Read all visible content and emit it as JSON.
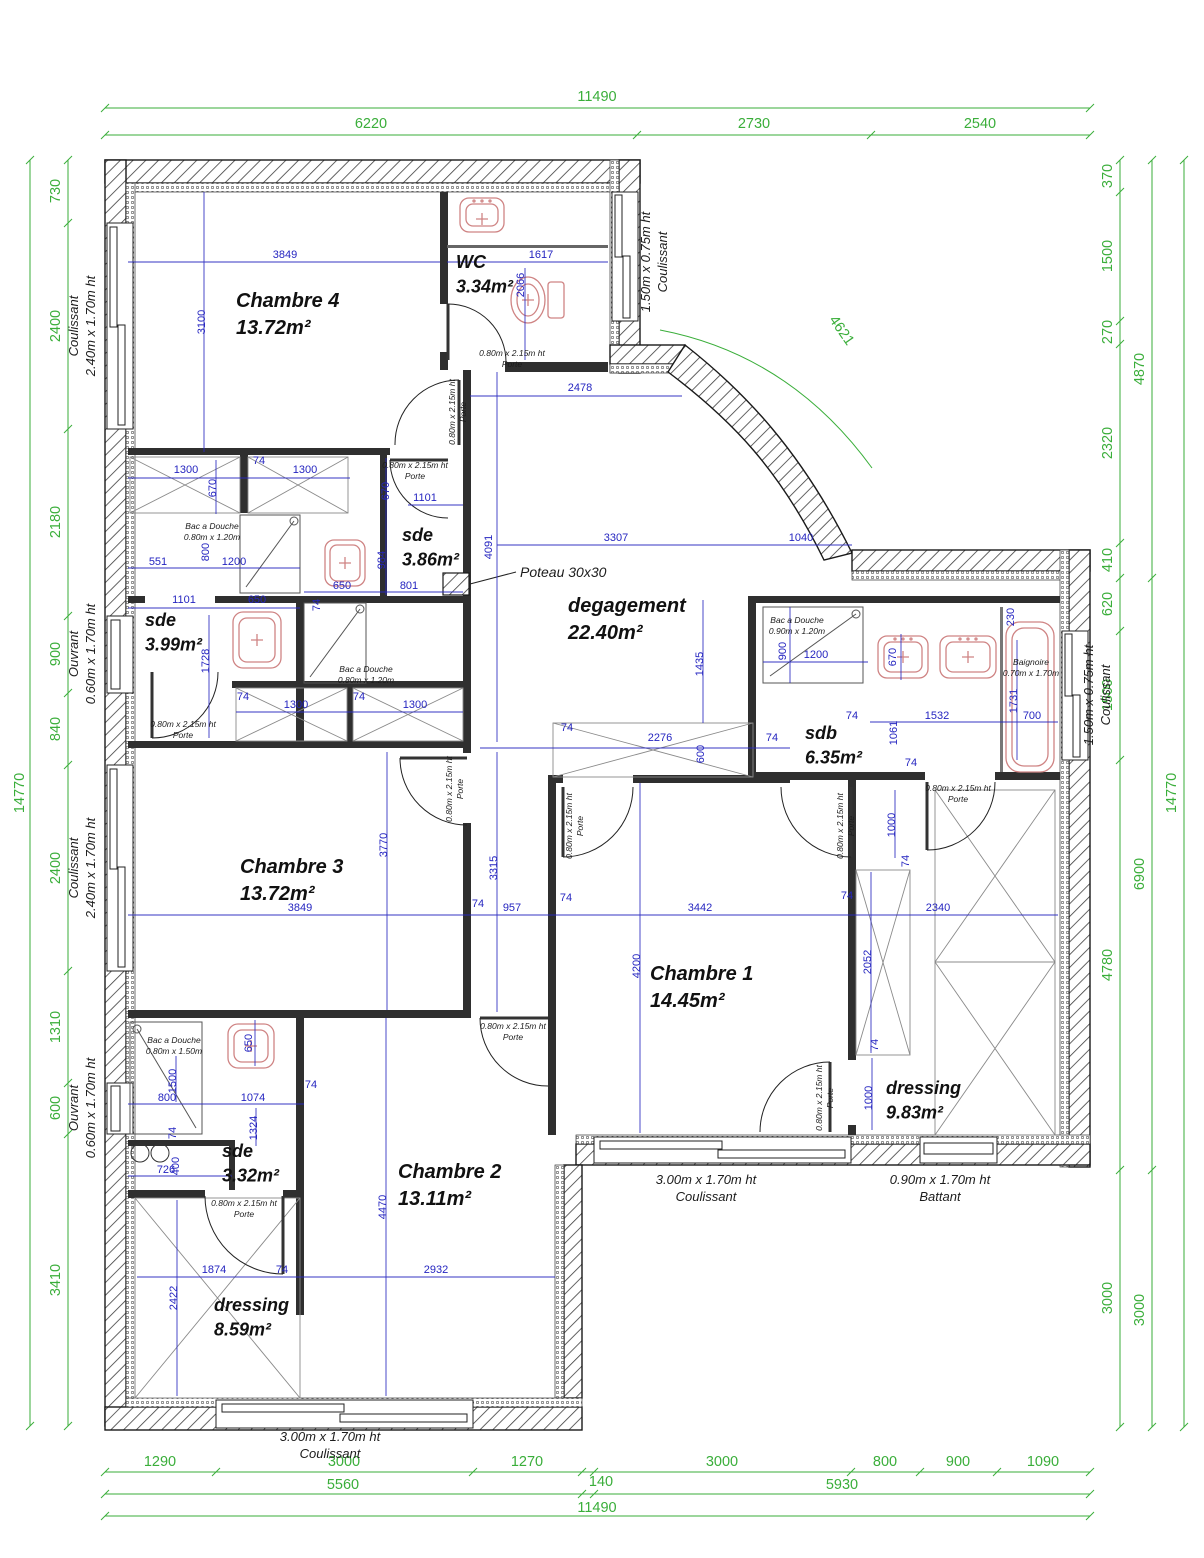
{
  "plan": {
    "type": "architectural-floor-plan",
    "units": "mm",
    "colors": {
      "dimension_green": "#3aae3a",
      "dimension_blue": "#2525c0",
      "fixture_red": "#cf8484",
      "wall": "#2f2f2f"
    }
  },
  "rooms": [
    {
      "id": "chambre-4",
      "name": "Chambre 4",
      "area": "13.72m²",
      "x": 236,
      "y": 307,
      "size": 20
    },
    {
      "id": "wc",
      "name": "WC",
      "area": "3.34m²",
      "x": 456,
      "y": 268,
      "size": 18
    },
    {
      "id": "sde-3-86",
      "name": "sde",
      "area": "3.86m²",
      "x": 402,
      "y": 541,
      "size": 18
    },
    {
      "id": "sde-3-99",
      "name": "sde",
      "area": "3.99m²",
      "x": 145,
      "y": 626,
      "size": 18
    },
    {
      "id": "degagement",
      "name": "degagement",
      "area": "22.40m²",
      "x": 568,
      "y": 612,
      "size": 20
    },
    {
      "id": "sdb",
      "name": "sdb",
      "area": "6.35m²",
      "x": 805,
      "y": 739,
      "size": 18
    },
    {
      "id": "chambre-3",
      "name": "Chambre 3",
      "area": "13.72m²",
      "x": 240,
      "y": 873,
      "size": 20
    },
    {
      "id": "chambre-1",
      "name": "Chambre 1",
      "area": "14.45m²",
      "x": 650,
      "y": 980,
      "size": 20
    },
    {
      "id": "dressing-9-83",
      "name": "dressing",
      "area": "9.83m²",
      "x": 886,
      "y": 1094,
      "size": 18
    },
    {
      "id": "chambre-2",
      "name": "Chambre 2",
      "area": "13.11m²",
      "x": 398,
      "y": 1178,
      "size": 20
    },
    {
      "id": "sde-3-32",
      "name": "sde",
      "area": "3.32m²",
      "x": 222,
      "y": 1157,
      "size": 18
    },
    {
      "id": "dressing-8-59",
      "name": "dressing",
      "area": "8.59m²",
      "x": 214,
      "y": 1311,
      "size": 18
    }
  ],
  "green_dims": [
    {
      "t": "11490",
      "x": 597,
      "y": 101
    },
    {
      "t": "6220",
      "x": 371,
      "y": 128
    },
    {
      "t": "2730",
      "x": 754,
      "y": 128
    },
    {
      "t": "2540",
      "x": 980,
      "y": 128
    },
    {
      "t": "1290",
      "x": 160,
      "y": 1466
    },
    {
      "t": "3000",
      "x": 344,
      "y": 1466
    },
    {
      "t": "1270",
      "x": 527,
      "y": 1466
    },
    {
      "t": "3000",
      "x": 722,
      "y": 1466
    },
    {
      "t": "800",
      "x": 885,
      "y": 1466
    },
    {
      "t": "900",
      "x": 958,
      "y": 1466
    },
    {
      "t": "1090",
      "x": 1043,
      "y": 1466
    },
    {
      "t": "5560",
      "x": 343,
      "y": 1489
    },
    {
      "t": "140",
      "x": 601,
      "y": 1486
    },
    {
      "t": "5930",
      "x": 842,
      "y": 1489
    },
    {
      "t": "11490",
      "x": 597,
      "y": 1512
    },
    {
      "t": "730",
      "x": 60,
      "y": 191,
      "rot": -90
    },
    {
      "t": "2400",
      "x": 60,
      "y": 326,
      "rot": -90
    },
    {
      "t": "2180",
      "x": 60,
      "y": 522,
      "rot": -90
    },
    {
      "t": "900",
      "x": 60,
      "y": 654,
      "rot": -90
    },
    {
      "t": "840",
      "x": 60,
      "y": 729,
      "rot": -90
    },
    {
      "t": "2400",
      "x": 60,
      "y": 868,
      "rot": -90
    },
    {
      "t": "1310",
      "x": 60,
      "y": 1027,
      "rot": -90
    },
    {
      "t": "600",
      "x": 60,
      "y": 1108,
      "rot": -90
    },
    {
      "t": "3410",
      "x": 60,
      "y": 1280,
      "rot": -90
    },
    {
      "t": "14770",
      "x": 24,
      "y": 793,
      "rot": -90
    },
    {
      "t": "370",
      "x": 1112,
      "y": 176,
      "rot": -90
    },
    {
      "t": "1500",
      "x": 1112,
      "y": 256,
      "rot": -90
    },
    {
      "t": "270",
      "x": 1112,
      "y": 332,
      "rot": -90
    },
    {
      "t": "2320",
      "x": 1112,
      "y": 443,
      "rot": -90
    },
    {
      "t": "410",
      "x": 1112,
      "y": 560,
      "rot": -90
    },
    {
      "t": "620",
      "x": 1112,
      "y": 604,
      "rot": -90
    },
    {
      "t": "1500",
      "x": 1112,
      "y": 695,
      "rot": -90
    },
    {
      "t": "4780",
      "x": 1112,
      "y": 965,
      "rot": -90
    },
    {
      "t": "3000",
      "x": 1112,
      "y": 1298,
      "rot": -90
    },
    {
      "t": "4870",
      "x": 1144,
      "y": 369,
      "rot": -90
    },
    {
      "t": "6900",
      "x": 1144,
      "y": 874,
      "rot": -90
    },
    {
      "t": "3000",
      "x": 1144,
      "y": 1310,
      "rot": -90
    },
    {
      "t": "14770",
      "x": 1176,
      "y": 793,
      "rot": -90
    },
    {
      "t": "4621",
      "x": 838,
      "y": 333,
      "rot": 55
    }
  ],
  "blue_dims": [
    {
      "t": "3849",
      "x": 285,
      "y": 258
    },
    {
      "t": "3100",
      "x": 205,
      "y": 322,
      "rot": -90
    },
    {
      "t": "1617",
      "x": 541,
      "y": 258
    },
    {
      "t": "2066",
      "x": 524,
      "y": 285,
      "rot": -90
    },
    {
      "t": "2478",
      "x": 580,
      "y": 391
    },
    {
      "t": "1300",
      "x": 186,
      "y": 473
    },
    {
      "t": "74",
      "x": 259,
      "y": 464
    },
    {
      "t": "1300",
      "x": 305,
      "y": 473
    },
    {
      "t": "670",
      "x": 216,
      "y": 488,
      "rot": -90
    },
    {
      "t": "670",
      "x": 389,
      "y": 491,
      "rot": -90
    },
    {
      "t": "1101",
      "x": 425,
      "y": 501
    },
    {
      "t": "984",
      "x": 385,
      "y": 560,
      "rot": -90
    },
    {
      "t": "650",
      "x": 342,
      "y": 589
    },
    {
      "t": "801",
      "x": 409,
      "y": 589
    },
    {
      "t": "74",
      "x": 320,
      "y": 605,
      "rot": -90
    },
    {
      "t": "551",
      "x": 158,
      "y": 565
    },
    {
      "t": "1200",
      "x": 234,
      "y": 565
    },
    {
      "t": "800",
      "x": 209,
      "y": 552,
      "rot": -90
    },
    {
      "t": "1101",
      "x": 184,
      "y": 603
    },
    {
      "t": "650",
      "x": 257,
      "y": 603
    },
    {
      "t": "1728",
      "x": 209,
      "y": 661,
      "rot": -90
    },
    {
      "t": "74",
      "x": 243,
      "y": 700
    },
    {
      "t": "1300",
      "x": 296,
      "y": 708
    },
    {
      "t": "74",
      "x": 359,
      "y": 700
    },
    {
      "t": "1300",
      "x": 415,
      "y": 708
    },
    {
      "t": "4091",
      "x": 492,
      "y": 547,
      "rot": -90
    },
    {
      "t": "3307",
      "x": 616,
      "y": 541
    },
    {
      "t": "1040",
      "x": 801,
      "y": 541
    },
    {
      "t": "1435",
      "x": 703,
      "y": 664,
      "rot": -90
    },
    {
      "t": "74",
      "x": 567,
      "y": 731
    },
    {
      "t": "2276",
      "x": 660,
      "y": 741
    },
    {
      "t": "600",
      "x": 704,
      "y": 754,
      "rot": -90
    },
    {
      "t": "74",
      "x": 772,
      "y": 741
    },
    {
      "t": "900",
      "x": 786,
      "y": 651,
      "rot": -90
    },
    {
      "t": "1200",
      "x": 816,
      "y": 658
    },
    {
      "t": "670",
      "x": 896,
      "y": 657,
      "rot": -90
    },
    {
      "t": "230",
      "x": 1014,
      "y": 617,
      "rot": -90
    },
    {
      "t": "1731",
      "x": 1017,
      "y": 701,
      "rot": -90
    },
    {
      "t": "1532",
      "x": 937,
      "y": 719
    },
    {
      "t": "700",
      "x": 1032,
      "y": 719
    },
    {
      "t": "1061",
      "x": 897,
      "y": 733,
      "rot": -90
    },
    {
      "t": "74",
      "x": 911,
      "y": 766
    },
    {
      "t": "74",
      "x": 852,
      "y": 719
    },
    {
      "t": "3770",
      "x": 387,
      "y": 845,
      "rot": -90
    },
    {
      "t": "3315",
      "x": 497,
      "y": 868,
      "rot": -90
    },
    {
      "t": "3849",
      "x": 300,
      "y": 911
    },
    {
      "t": "74",
      "x": 478,
      "y": 907
    },
    {
      "t": "957",
      "x": 512,
      "y": 911
    },
    {
      "t": "3442",
      "x": 700,
      "y": 911
    },
    {
      "t": "74",
      "x": 566,
      "y": 901
    },
    {
      "t": "4200",
      "x": 640,
      "y": 966,
      "rot": -90
    },
    {
      "t": "2340",
      "x": 938,
      "y": 911
    },
    {
      "t": "74",
      "x": 847,
      "y": 899
    },
    {
      "t": "2052",
      "x": 871,
      "y": 962,
      "rot": -90
    },
    {
      "t": "74",
      "x": 878,
      "y": 1045,
      "rot": -90
    },
    {
      "t": "1000",
      "x": 872,
      "y": 1098,
      "rot": -90
    },
    {
      "t": "1000",
      "x": 895,
      "y": 825,
      "rot": -90
    },
    {
      "t": "74",
      "x": 909,
      "y": 861,
      "rot": -90
    },
    {
      "t": "650",
      "x": 252,
      "y": 1043,
      "rot": -90
    },
    {
      "t": "1500",
      "x": 176,
      "y": 1081,
      "rot": -90
    },
    {
      "t": "800",
      "x": 167,
      "y": 1101
    },
    {
      "t": "74",
      "x": 176,
      "y": 1133,
      "rot": -90
    },
    {
      "t": "1074",
      "x": 253,
      "y": 1101
    },
    {
      "t": "1324",
      "x": 257,
      "y": 1128,
      "rot": -90
    },
    {
      "t": "726",
      "x": 166,
      "y": 1173
    },
    {
      "t": "400",
      "x": 179,
      "y": 1166,
      "rot": -90
    },
    {
      "t": "74",
      "x": 311,
      "y": 1088
    },
    {
      "t": "4470",
      "x": 386,
      "y": 1207,
      "rot": -90
    },
    {
      "t": "1874",
      "x": 214,
      "y": 1273
    },
    {
      "t": "74",
      "x": 282,
      "y": 1273
    },
    {
      "t": "2932",
      "x": 436,
      "y": 1273
    },
    {
      "t": "2422",
      "x": 177,
      "y": 1298,
      "rot": -90
    }
  ],
  "annotations": [
    {
      "lines": [
        "0.80m x 2.15m ht",
        "Porte"
      ],
      "x": 512,
      "y": 356
    },
    {
      "lines": [
        "0.80m x 2.15m ht",
        "Porte"
      ],
      "x": 455,
      "y": 412,
      "rot": -90
    },
    {
      "lines": [
        "0.80m x 2.15m ht",
        "Porte"
      ],
      "x": 415,
      "y": 468
    },
    {
      "lines": [
        "Bac a Douche",
        "0.80m x 1.20m"
      ],
      "x": 212,
      "y": 529
    },
    {
      "lines": [
        "Bac a Douche",
        "0.80m x 1.20m"
      ],
      "x": 366,
      "y": 672
    },
    {
      "lines": [
        "0.80m x 2.15m ht",
        "Porte"
      ],
      "x": 183,
      "y": 727
    },
    {
      "lines": [
        "Bac a Douche",
        "0.90m x 1.20m"
      ],
      "x": 797,
      "y": 623
    },
    {
      "lines": [
        "Baignoire",
        "0.70m x 1.70m"
      ],
      "x": 1031,
      "y": 665
    },
    {
      "lines": [
        "0.80m x 2.15m ht",
        "Porte"
      ],
      "x": 452,
      "y": 789,
      "rot": -90
    },
    {
      "lines": [
        "0.80m x 2.15m ht",
        "Porte"
      ],
      "x": 572,
      "y": 826,
      "rot": -90
    },
    {
      "lines": [
        "0.80m x 2.15m ht",
        "Porte"
      ],
      "x": 843,
      "y": 826,
      "rot": -90
    },
    {
      "lines": [
        "0.80m x 2.15m ht",
        "Porte"
      ],
      "x": 958,
      "y": 791
    },
    {
      "lines": [
        "0.80m x 2.15m ht",
        "Porte"
      ],
      "x": 822,
      "y": 1098,
      "rot": -90
    },
    {
      "lines": [
        "0.80m x 2.15m ht",
        "Porte"
      ],
      "x": 513,
      "y": 1029
    },
    {
      "lines": [
        "Bac a Douche",
        "0.80m x 1.50m"
      ],
      "x": 174,
      "y": 1043
    },
    {
      "lines": [
        "0.80m x 2.15m ht",
        "Porte"
      ],
      "x": 244,
      "y": 1206
    },
    {
      "lines": [
        "Poteau 30x30"
      ],
      "x": 520,
      "y": 577,
      "size": 14,
      "anchor": "start"
    },
    {
      "lines": [
        "1.50m x 0.75m ht",
        "Coulissant"
      ],
      "x": 650,
      "y": 262,
      "rot": -90,
      "size": 13
    },
    {
      "lines": [
        "1.50m x 0.75m ht",
        "Coulissant"
      ],
      "x": 1093,
      "y": 695,
      "rot": -90,
      "size": 13
    },
    {
      "lines": [
        "Coulissant",
        "2.40m x 1.70m ht"
      ],
      "x": 78,
      "y": 326,
      "rot": -90,
      "size": 13
    },
    {
      "lines": [
        "Ouvrant",
        "0.60m x 1.70m ht"
      ],
      "x": 78,
      "y": 654,
      "rot": -90,
      "size": 13
    },
    {
      "lines": [
        "Coulissant",
        "2.40m x 1.70m ht"
      ],
      "x": 78,
      "y": 868,
      "rot": -90,
      "size": 13
    },
    {
      "lines": [
        "Ouvrant",
        "0.60m x 1.70m ht"
      ],
      "x": 78,
      "y": 1108,
      "rot": -90,
      "size": 13
    },
    {
      "lines": [
        "3.00m x 1.70m ht",
        "Coulissant"
      ],
      "x": 330,
      "y": 1441,
      "size": 13
    },
    {
      "lines": [
        "3.00m x 1.70m ht",
        "Coulissant"
      ],
      "x": 706,
      "y": 1184,
      "size": 13
    },
    {
      "lines": [
        "0.90m x 1.70m ht",
        "Battant"
      ],
      "x": 940,
      "y": 1184,
      "size": 13
    }
  ]
}
